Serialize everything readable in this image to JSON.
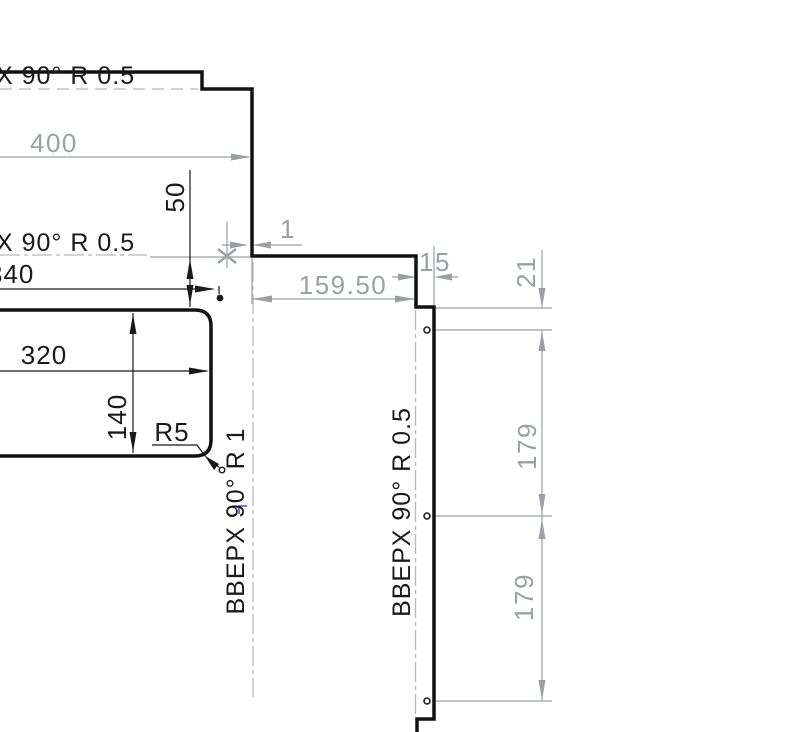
{
  "canvas": {
    "width": 790,
    "height": 732,
    "background": "#ffffff"
  },
  "colors": {
    "part_edge": "#121212",
    "dim_black": "#1a1a1a",
    "dim_gray": "#9aa0a6",
    "bend_line_gray": "#b8b8b8",
    "cursor_blue": "#4356e0"
  },
  "annotations": {
    "bend_top": "X  90°  R 0.5",
    "bend_mid": "X  90°  R 0.5",
    "bend_left": "BBEPX  90°  R 1",
    "bend_right": "BBEPX  90°  R 0.5"
  },
  "dims": {
    "d400": "400",
    "d50": "50",
    "d340": "340",
    "d320": "320",
    "d140": "140",
    "r5": "R5",
    "d1": "1",
    "d159": "159.50",
    "d15": "15",
    "d21": "21",
    "d179_top": "179",
    "d179_bottom": "179"
  }
}
